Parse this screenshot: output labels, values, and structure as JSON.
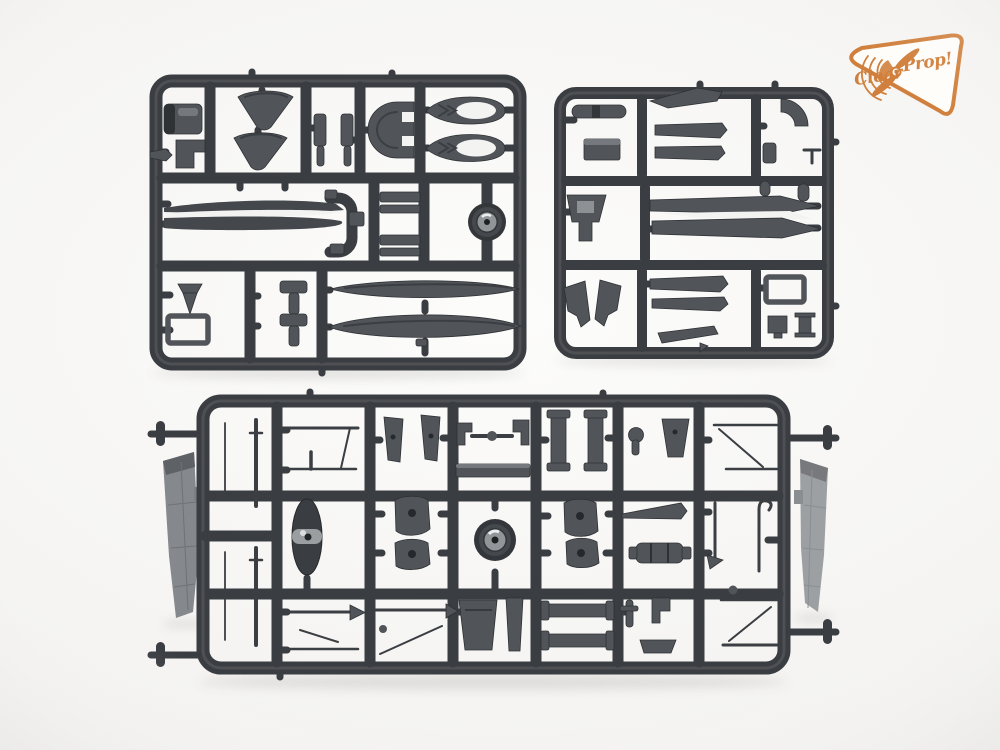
{
  "scene": {
    "type": "product-photo",
    "subject": "Three injection-molded dark grey styrene model kit sprues photographed on a white studio background",
    "sprue_top_left": "rectangular parts frame with engine cowl, fairings, canopy arch, pod halves with oval openings, long blades, ladder details, a wheel and two float halves",
    "sprue_top_right": "rectangular parts frame with fuselage spine, tapered tailplane halves, seat, cowl halves and small fittings",
    "sprue_bottom": "wide parts frame with two wing panels attached outside the side rails, antennas, spinner, wheel, paddle-shaped covers, struts and rigging wires"
  },
  "logo": {
    "text_clear": "Clear",
    "text_prop": "Prop!"
  },
  "colors": {
    "background": "#f5f4f2",
    "plastic": "#3a3d41",
    "plastic_dark": "#2b2e31",
    "part": "#51555a",
    "part_light": "#75797e",
    "hub": "#929598",
    "highlight": "#f3f3f2",
    "wing_left": "#85888c",
    "wing_right": "#9da0a3",
    "logo_orange": "#d0803c",
    "logo_fill": "#fefdfa"
  }
}
